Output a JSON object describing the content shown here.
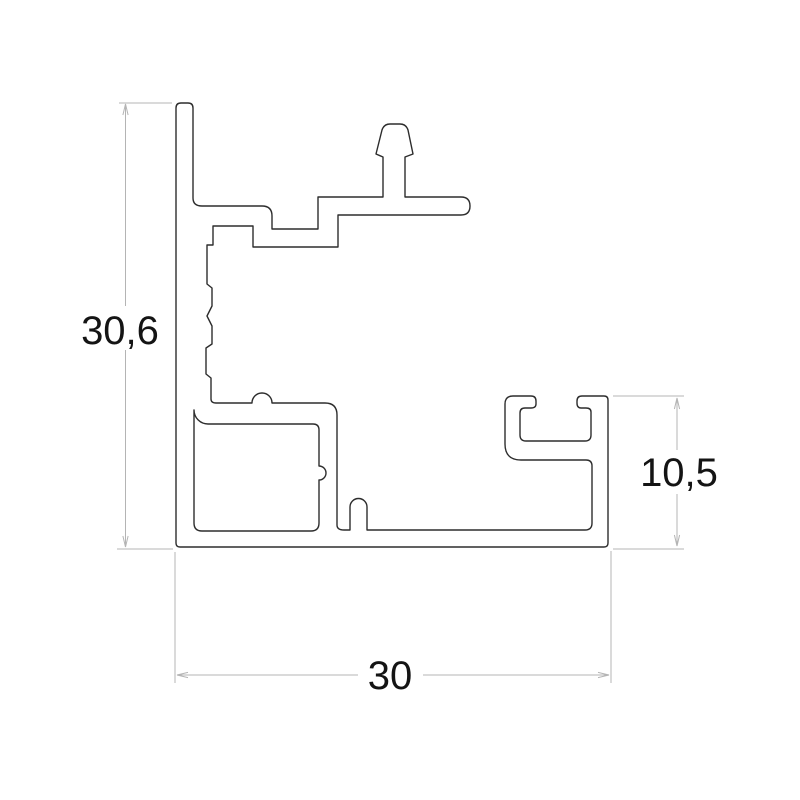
{
  "drawing": {
    "type": "technical-cross-section",
    "colors": {
      "background": "#ffffff",
      "outline": "#2d2d2d",
      "dimension_lines": "#b4b4b4",
      "text": "#141414"
    },
    "dimensions": {
      "overall_height": "30,6",
      "right_height": "10,5",
      "overall_width": "30"
    }
  }
}
